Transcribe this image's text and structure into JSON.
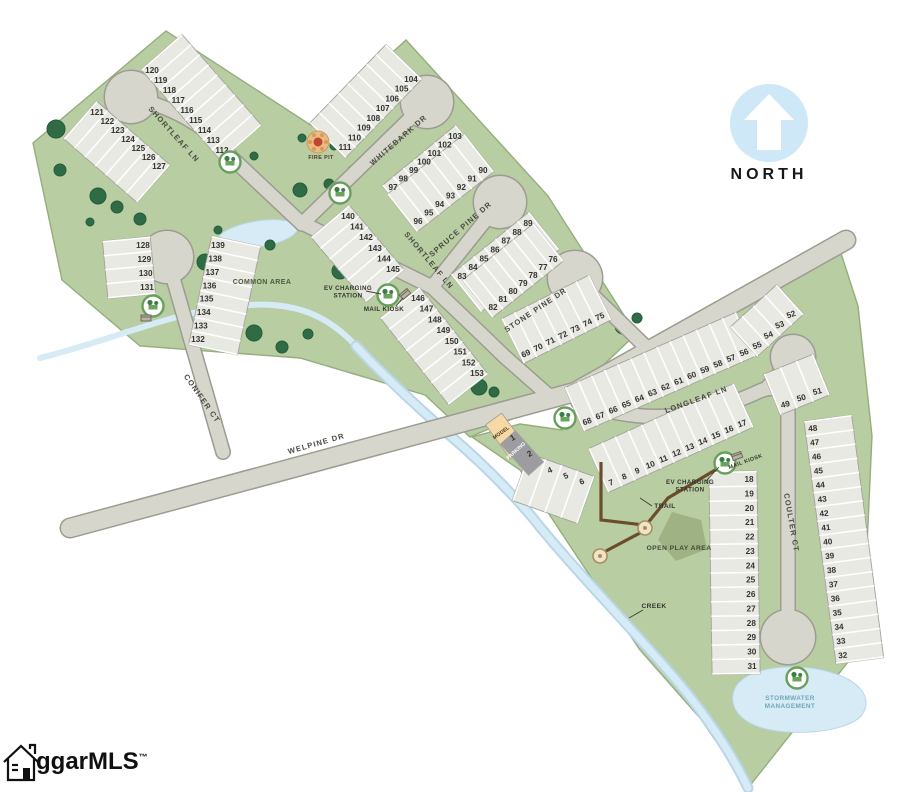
{
  "north": {
    "label": "NORTH"
  },
  "logo": {
    "text": "ggarMLS",
    "trademark": "™"
  },
  "colors": {
    "land": "#b8cda2",
    "land_edge": "#94ae7d",
    "road": "#d6d6cc",
    "road_edge": "#9c9c92",
    "lot": "#e9e9e4",
    "lot_edge": "#a3a39b",
    "water": "#d6ebf5",
    "water_edge": "#b8d7e8",
    "tree": "#2f6b44",
    "tree_dark": "#255c39",
    "trail": "#6b4d2b",
    "hill": "#9fb284",
    "model": "#f6d9a4",
    "parking": "#9d9da1",
    "marker_ring": "#67a05a",
    "north_circle": "#cfe8f7",
    "fire_pit": "#e8bc85",
    "fire": "#c4452e",
    "label_dark": "#3f3f38",
    "pond_label": "#6fa7b8",
    "number": "#33332f"
  },
  "streets": [
    {
      "id": "shortleaf-north",
      "label": "SHORTLEAF LN"
    },
    {
      "id": "whitebark",
      "label": "WHITEBARK DR"
    },
    {
      "id": "shortleaf-south",
      "label": "SHORTLEAF LN"
    },
    {
      "id": "spruce-pine",
      "label": "SPRUCE PINE DR"
    },
    {
      "id": "stone-pine",
      "label": "STONE PINE DR"
    },
    {
      "id": "longleaf",
      "label": "LONGLEAF LN"
    },
    {
      "id": "welpine",
      "label": "WELPINE DR"
    },
    {
      "id": "conifer",
      "label": "CONIFER CT"
    },
    {
      "id": "coulter",
      "label": "COULTER CT"
    }
  ],
  "labels": [
    {
      "id": "common-area",
      "text": "COMMON AREA"
    },
    {
      "id": "fire-pit",
      "text": "FIRE PIT"
    },
    {
      "id": "ev-station-west",
      "text": "EV CHARGING STATION"
    },
    {
      "id": "mail-kiosk-west",
      "text": "MAIL KIOSK"
    },
    {
      "id": "ev-station-east",
      "text": "EV CHARGING STATION"
    },
    {
      "id": "mail-kiosk-east",
      "text": "MAIL KIOSK"
    },
    {
      "id": "trail",
      "text": "TRAIL"
    },
    {
      "id": "open-play-area",
      "text": "OPEN PLAY AREA"
    },
    {
      "id": "creek",
      "text": "CREEK"
    },
    {
      "id": "stormwater",
      "text": "STORMWATER MANAGEMENT"
    },
    {
      "id": "model",
      "text": "MODEL"
    },
    {
      "id": "parking",
      "text": "PARKING"
    }
  ],
  "lot_strips": [
    {
      "id": "shortleaf-n-east",
      "numbers": [
        120,
        119,
        118,
        117,
        116,
        115,
        114,
        113,
        112
      ]
    },
    {
      "id": "shortleaf-n-west",
      "numbers": [
        121,
        122,
        123,
        124,
        125,
        126,
        127
      ]
    },
    {
      "id": "whitebark-west",
      "numbers": [
        104,
        105,
        106,
        107,
        108,
        109,
        110,
        111
      ]
    },
    {
      "id": "whitebark-east",
      "numbers": [
        103,
        102,
        101,
        100,
        99,
        98,
        97
      ]
    },
    {
      "id": "spruce-west",
      "numbers": [
        90,
        91,
        92,
        93,
        94,
        95,
        96
      ]
    },
    {
      "id": "spruce-east",
      "numbers": [
        89,
        88,
        87,
        86,
        85,
        84,
        83
      ]
    },
    {
      "id": "stone-west",
      "numbers": [
        76,
        77,
        78,
        79,
        80,
        81,
        82
      ]
    },
    {
      "id": "stone-south",
      "numbers": [
        69,
        70,
        71,
        72,
        73,
        74,
        75
      ]
    },
    {
      "id": "shortleaf-s-west-upper",
      "numbers": [
        140,
        141,
        142,
        143,
        144,
        145
      ]
    },
    {
      "id": "shortleaf-s-west-lower",
      "numbers": [
        146,
        147,
        148,
        149,
        150,
        151,
        152,
        153
      ]
    },
    {
      "id": "conifer-west",
      "numbers": [
        128,
        129,
        130,
        131
      ]
    },
    {
      "id": "conifer-east",
      "numbers": [
        139,
        138,
        137,
        136,
        135,
        134,
        133,
        132
      ]
    },
    {
      "id": "longleaf-north",
      "numbers": [
        68,
        67,
        66,
        65,
        64,
        63,
        62,
        61,
        60,
        59,
        58,
        57,
        56
      ]
    },
    {
      "id": "longleaf-bulb",
      "numbers": [
        55,
        54,
        53,
        52
      ]
    },
    {
      "id": "longleaf-south",
      "numbers": [
        7,
        8,
        9,
        10,
        11,
        12,
        13,
        14,
        15,
        16,
        17
      ]
    },
    {
      "id": "welpine-curve",
      "numbers": [
        3,
        4,
        5,
        6
      ]
    },
    {
      "id": "model-lots",
      "numbers": [
        1,
        2
      ]
    },
    {
      "id": "coulter-west",
      "numbers": [
        18,
        19,
        20,
        21,
        22,
        23,
        24,
        25,
        26,
        27,
        28,
        29,
        30,
        31
      ]
    },
    {
      "id": "coulter-ne",
      "numbers": [
        49,
        50,
        51
      ]
    },
    {
      "id": "coulter-east",
      "numbers": [
        48,
        47,
        46,
        45,
        44,
        43,
        42,
        41,
        40,
        39,
        38,
        37,
        36,
        35,
        34,
        33,
        32
      ]
    }
  ]
}
